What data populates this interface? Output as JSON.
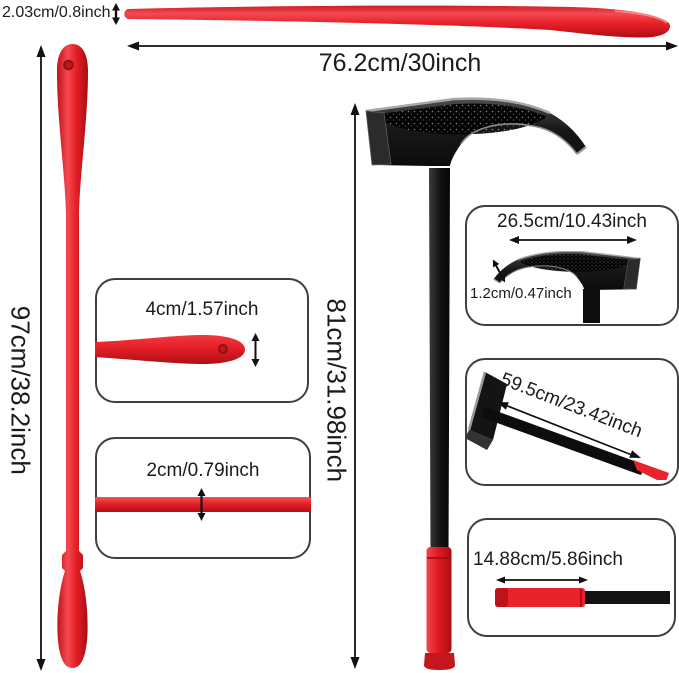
{
  "tire_spoon": {
    "thickness": "2.03cm/0.8inch",
    "length": "76.2cm/30inch",
    "length_vertical": "97cm/38.2inch",
    "tip_width": "4cm/1.57inch",
    "rod_diameter": "2cm/0.79inch"
  },
  "bead_hammer": {
    "total_length": "81cm/31.98inch",
    "head_length": "26.5cm/10.43inch",
    "blade_thickness": "1.2cm/0.47inch",
    "handle_length": "59.5cm/23.42inch",
    "grip_length": "14.88cm/5.86inch"
  },
  "colors": {
    "tool_red": "#e8232b",
    "tool_red_dark": "#b40f16",
    "tool_black": "#131313",
    "steel_gray": "#9a9a9a",
    "label_text": "#1b1b1b",
    "box_border": "#3f3f3f"
  }
}
